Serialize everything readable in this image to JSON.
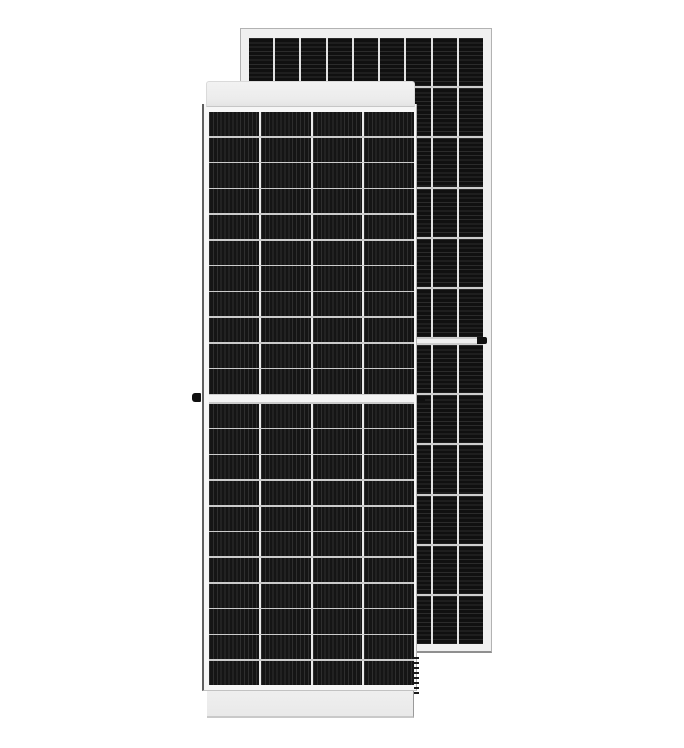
{
  "scene": {
    "description": "Product image of two framed black monocrystalline solar photovoltaic modules on a white background; the front module (front glass view, vertical cell striping) overlaps a taller rear module (horizontal striping) offset up and to the right.",
    "background_color": "#ffffff"
  },
  "front_panel": {
    "view": "front",
    "columns": 4,
    "rows_top_half": 11,
    "rows_bottom_half": 11,
    "stripe_orientation": "vertical",
    "stripe_pitch_px": 3.9,
    "cell_color": "#151515",
    "cell_stripe_color": "#2e2e2e",
    "row_divider_color": "#cbcbcb",
    "column_divider_color": "#eaeaea",
    "center_gap_color": "#f3f3f3",
    "center_gap_px": 7,
    "frame_color": "#eeeeee",
    "drain_hole_count": 8
  },
  "back_panel": {
    "view": "rear-offset",
    "columns": 9,
    "rows_top_half": 6,
    "rows_bottom_half": 6,
    "stripe_orientation": "horizontal",
    "stripe_pitch_px": 4.3,
    "cell_color": "#101010",
    "cell_stripe_color": "#2b2b2b",
    "row_divider_color": "#cdcdcd",
    "column_divider_color": "#e2e2e2",
    "center_gap_color": "#efefef",
    "center_gap_px": 4,
    "frame_color": "#f0f0f0"
  },
  "hardware": {
    "left_grounding_clip": true,
    "right_grounding_clip": true,
    "back_panel_clip": true
  }
}
